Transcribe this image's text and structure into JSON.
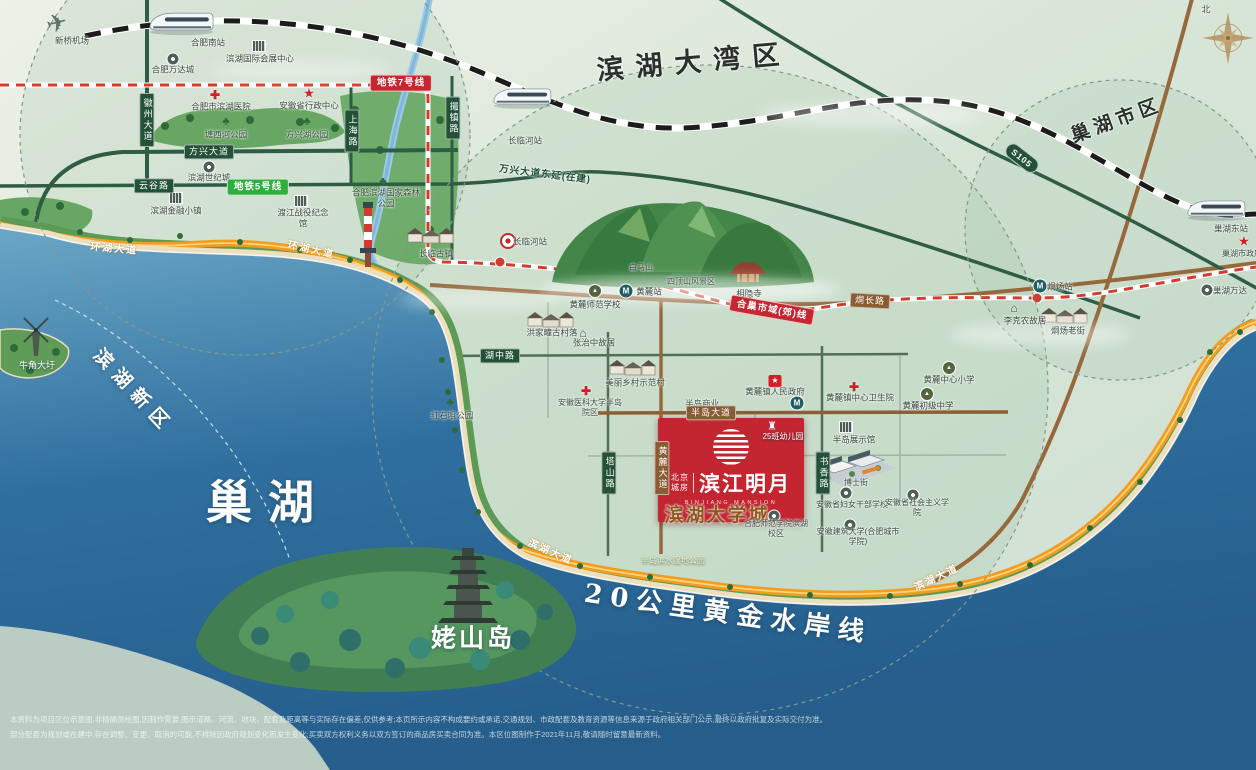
{
  "map": {
    "compass_north": "北",
    "project": {
      "dev1": "北京",
      "dev2": "城房",
      "name": "滨江明月",
      "name_en": "BINJIANG MANSION"
    },
    "disclaimer": [
      "本资料为项目区位示意图,非精确测绘图,因制作需要,图示道路、河流、地块、配套及距离等与实际存在偏差,仅供参考;本页所示内容不构成要约或承诺,交通规划、市政配套及教育资源等信息来源于政府相关部门公示,最终以政府批复及实际交付为准。",
      "部分配套为规划或在建中,存在调整、变更、取消的可能,不排除因政府规划变化而发生变化;买卖双方权利义务以双方签订的商品房买卖合同为准。本区位图制作于2021年11月,敬请随时留意最新资料。"
    ],
    "labels": [
      {
        "n": "label-binhu-bay-area",
        "t": "滨湖大湾区",
        "c": "big-dark",
        "x": 694,
        "y": 63,
        "r": -5,
        "fs": 27,
        "ls": 12
      },
      {
        "n": "label-chaohu-city-area",
        "t": "巢湖市区",
        "c": "big-dark",
        "x": 1117,
        "y": 121,
        "r": -20,
        "fs": 19,
        "ls": 5
      },
      {
        "n": "label-chaohu-lake",
        "t": "巢湖",
        "c": "big-white",
        "x": 268,
        "y": 503,
        "fs": 46,
        "ls": 16
      },
      {
        "n": "label-binhu-new-district",
        "t": "滨湖新区",
        "c": "big-white",
        "x": 133,
        "y": 392,
        "r": 47,
        "fs": 19,
        "ls": 8
      },
      {
        "n": "label-laoshan-island",
        "t": "姥山岛",
        "c": "big-white",
        "x": 473,
        "y": 639,
        "fs": 25,
        "ls": 3
      },
      {
        "n": "label-golden-waterfront",
        "t": "20公里黄金水岸线",
        "c": "big-white serif",
        "x": 728,
        "y": 614,
        "r": 8,
        "fs": 26,
        "ls": 8
      },
      {
        "n": "label-niujiao-daxu",
        "t": "牛角大圩",
        "c": "poi-white",
        "x": 37,
        "y": 366,
        "fs": 9
      },
      {
        "n": "label-binhu-university-town",
        "t": "滨湖大学城",
        "c": "big-brown",
        "x": 717,
        "y": 516,
        "fs": 19,
        "ls": 2
      },
      {
        "n": "label-compass-north",
        "t": "北",
        "x": 1206,
        "y": 10,
        "fs": 9
      },
      {
        "n": "poi-xinqiao-airport",
        "t": "新桥机场",
        "x": 72,
        "y": 41
      },
      {
        "n": "poi-hefei-south-station",
        "t": "合肥南站",
        "x": 208,
        "y": 43
      },
      {
        "n": "poi-binhu-convention-center",
        "t": "滨湖国际会展中心",
        "x": 260,
        "y": 59
      },
      {
        "n": "poi-hefei-wanda-city",
        "t": "合肥万达城",
        "x": 173,
        "y": 70
      },
      {
        "n": "poi-binhu-hospital",
        "t": "合肥市滨湖医院",
        "x": 221,
        "y": 107
      },
      {
        "n": "poi-anhui-admin-center",
        "t": "安徽省行政中心",
        "x": 309,
        "y": 106
      },
      {
        "n": "poi-tangxihe-park",
        "t": "塘西河公园",
        "x": 226,
        "y": 135
      },
      {
        "n": "poi-fangxinghu-park",
        "t": "方兴湖公园",
        "x": 307,
        "y": 135
      },
      {
        "n": "poi-binhu-century-city",
        "t": "滨湖世纪城",
        "x": 209,
        "y": 178
      },
      {
        "n": "poi-binhu-finance-town",
        "t": "滨湖金融小镇",
        "x": 176,
        "y": 211
      },
      {
        "n": "poi-dujiang-memorial",
        "t": "渡江战役纪念馆",
        "x": 303,
        "y": 218,
        "w": 58
      },
      {
        "n": "poi-binhu-forest-park",
        "t": "合肥滨湖国家森林公园",
        "x": 386,
        "y": 198,
        "w": 72
      },
      {
        "n": "poi-hongshiju-park",
        "t": "红石咀公园",
        "x": 452,
        "y": 416
      },
      {
        "n": "poi-changlin-old-town",
        "t": "长临古镇",
        "x": 436,
        "y": 254
      },
      {
        "n": "poi-changlinhe-rail-station",
        "t": "长临河站",
        "x": 525,
        "y": 141
      },
      {
        "n": "poi-changlinhe-metro-station",
        "t": "长临河站",
        "x": 530,
        "y": 242
      },
      {
        "n": "poi-baima-mountain",
        "t": "白马山",
        "x": 641,
        "y": 268,
        "fs": 8
      },
      {
        "n": "poi-dingshan-scenic-area",
        "t": "四顶山风景区",
        "x": 691,
        "y": 282,
        "fs": 8
      },
      {
        "n": "poi-xiangyin-temple",
        "t": "相隐寺",
        "x": 749,
        "y": 294
      },
      {
        "n": "poi-huanglu-station",
        "t": "黄麓站",
        "x": 649,
        "y": 292
      },
      {
        "n": "poi-huanglu-normal-school",
        "t": "黄麓师范学校",
        "x": 595,
        "y": 305
      },
      {
        "n": "poi-hongjiatuan-village",
        "t": "洪家疃古村落",
        "x": 552,
        "y": 333
      },
      {
        "n": "poi-zhangzhizhong-residence",
        "t": "张治中故居",
        "x": 594,
        "y": 343
      },
      {
        "n": "poi-model-village",
        "t": "美丽乡村示范村",
        "x": 635,
        "y": 383
      },
      {
        "n": "poi-medical-univ-hospital",
        "t": "安徽医科大学半岛院区",
        "x": 590,
        "y": 408,
        "w": 66,
        "fs": 8
      },
      {
        "n": "poi-huanglu-government",
        "t": "黄麓镇人民政府",
        "x": 775,
        "y": 392
      },
      {
        "n": "poi-peninsula-commercial",
        "t": "半岛商业",
        "x": 702,
        "y": 404
      },
      {
        "n": "poi-huanglu-health-center",
        "t": "黄麓镇中心卫生院",
        "x": 860,
        "y": 398
      },
      {
        "n": "poi-huanglu-primary-school",
        "t": "黄麓中心小学",
        "x": 949,
        "y": 380
      },
      {
        "n": "poi-huanglu-middle-school",
        "t": "黄麓初级中学",
        "x": 928,
        "y": 406
      },
      {
        "n": "poi-peninsula-exhibition-hall",
        "t": "半岛展示馆",
        "x": 854,
        "y": 440
      },
      {
        "n": "poi-boshi-street",
        "t": "博士街",
        "x": 856,
        "y": 483,
        "fs": 8
      },
      {
        "n": "poi-women-cadre-school",
        "t": "安徽省妇女干部学校",
        "x": 852,
        "y": 505,
        "fs": 8
      },
      {
        "n": "poi-socialism-college",
        "t": "安徽省社会主义学院",
        "x": 917,
        "y": 508,
        "w": 64,
        "fs": 8
      },
      {
        "n": "poi-hefei-normal-univ",
        "t": "合肥师范学院滨湖校区",
        "x": 776,
        "y": 529,
        "w": 66,
        "fs": 8
      },
      {
        "n": "poi-anhui-jianzhu-univ",
        "t": "安徽建筑大学(合肥城市学院)",
        "x": 858,
        "y": 537,
        "w": 84,
        "fs": 8
      },
      {
        "n": "poi-wetland-park",
        "t": "半岛滨水湿地公园",
        "c": "poi-light",
        "x": 673,
        "y": 561,
        "fs": 8
      },
      {
        "n": "poi-kindergarten",
        "t": "25班幼儿园",
        "c": "poi-white",
        "x": 783,
        "y": 437,
        "fs": 8
      },
      {
        "n": "poi-tongyang-station",
        "t": "烔炀站",
        "x": 1060,
        "y": 287
      },
      {
        "n": "poi-likenong-residence",
        "t": "李克农故居",
        "x": 1025,
        "y": 321
      },
      {
        "n": "poi-tongyang-old-street",
        "t": "烔炀老街",
        "x": 1068,
        "y": 331
      },
      {
        "n": "poi-chaohu-wanda",
        "t": "巢湖万达",
        "x": 1230,
        "y": 291
      },
      {
        "n": "poi-chaohu-government",
        "t": "巢湖市政府",
        "x": 1242,
        "y": 254,
        "fs": 8
      },
      {
        "n": "poi-chaohu-east-station",
        "t": "巢湖东站",
        "x": 1231,
        "y": 229
      },
      {
        "n": "road-huizhou-avenue",
        "t": "徽州大道",
        "c": "bar-g v",
        "x": 147,
        "y": 120
      },
      {
        "n": "road-fangxing-avenue",
        "t": "方兴大道",
        "c": "bar-g",
        "x": 209,
        "y": 152
      },
      {
        "n": "road-yungu-road",
        "t": "云谷路",
        "c": "bar-g",
        "x": 154,
        "y": 186
      },
      {
        "n": "road-shanghai-road",
        "t": "上海路",
        "c": "bar-g v",
        "x": 352,
        "y": 131
      },
      {
        "n": "road-cuozhen-road",
        "t": "撮镇路",
        "c": "bar-g v",
        "x": 453,
        "y": 118
      },
      {
        "n": "road-huzhong-road",
        "t": "湖中路",
        "c": "bar-g",
        "x": 500,
        "y": 356
      },
      {
        "n": "road-tashan-road",
        "t": "塔山路",
        "c": "bar-g v",
        "x": 609,
        "y": 473
      },
      {
        "n": "road-huanglu-avenue",
        "t": "黄麓大道",
        "c": "bar-br v",
        "x": 662,
        "y": 468
      },
      {
        "n": "road-shuxiang-road",
        "t": "书香路",
        "c": "bar-g v",
        "x": 823,
        "y": 473
      },
      {
        "n": "road-bandao-avenue",
        "t": "半岛大道",
        "c": "bar-br",
        "x": 711,
        "y": 413
      },
      {
        "n": "road-tongchang-road",
        "t": "烔长路",
        "c": "bar-br",
        "x": 870,
        "y": 301,
        "r": 3
      },
      {
        "n": "road-wanxing-extension",
        "t": "万兴大道东延(在建)",
        "c": "road-text-green",
        "x": 545,
        "y": 175,
        "r": 7
      },
      {
        "n": "road-huanhu-avenue-west",
        "t": "环湖大道",
        "c": "road-orange",
        "x": 114,
        "y": 250,
        "r": 5
      },
      {
        "n": "road-huanhu-avenue-east",
        "t": "环湖大道",
        "c": "road-orange",
        "x": 311,
        "y": 251,
        "r": 12
      },
      {
        "n": "road-binhu-avenue-south",
        "t": "滨湖大道",
        "c": "road-orange",
        "x": 550,
        "y": 553,
        "r": 24
      },
      {
        "n": "road-binhu-avenue-southeast",
        "t": "滨湖大道",
        "c": "road-orange",
        "x": 937,
        "y": 579,
        "r": -25
      },
      {
        "n": "badge-metro-line7",
        "t": "地铁7号线",
        "c": "badge-red",
        "x": 401,
        "y": 83
      },
      {
        "n": "badge-metro-line5",
        "t": "地铁5号线",
        "c": "badge-green",
        "x": 258,
        "y": 187
      },
      {
        "n": "badge-s105",
        "t": "S105",
        "c": "badge-s105",
        "x": 1022,
        "y": 158,
        "r": 38
      },
      {
        "n": "badge-hechao-suburban-line",
        "t": "合巢市域(郊)线",
        "c": "badge-red",
        "x": 772,
        "y": 310,
        "r": 10
      }
    ],
    "icons": [
      {
        "k": "plane",
        "n": "airplane-icon",
        "x": 57,
        "y": 24
      },
      {
        "k": "bldg",
        "n": "convention-center-icon",
        "x": 259,
        "y": 46
      },
      {
        "k": "dot",
        "n": "wanda-city-icon",
        "x": 173,
        "y": 59
      },
      {
        "k": "cross",
        "n": "binhu-hospital-icon",
        "x": 215,
        "y": 95
      },
      {
        "k": "star",
        "n": "admin-center-star-icon",
        "x": 309,
        "y": 93
      },
      {
        "k": "park",
        "n": "tangxihe-park-icon",
        "x": 226,
        "y": 122
      },
      {
        "k": "park",
        "n": "fangxinghu-park-icon",
        "x": 307,
        "y": 122
      },
      {
        "k": "dot",
        "n": "century-city-icon",
        "x": 209,
        "y": 167
      },
      {
        "k": "bldg",
        "n": "finance-town-icon",
        "x": 176,
        "y": 198
      },
      {
        "k": "bldg",
        "n": "dujiang-memorial-icon",
        "x": 301,
        "y": 201
      },
      {
        "k": "park",
        "n": "forest-park-icon",
        "x": 383,
        "y": 182
      },
      {
        "k": "park",
        "n": "hongshiju-park-icon",
        "x": 450,
        "y": 403
      },
      {
        "k": "station",
        "n": "changlinhe-metro-station-icon",
        "x": 508,
        "y": 241
      },
      {
        "k": "m",
        "n": "huanglu-station-m-icon",
        "x": 626,
        "y": 291
      },
      {
        "k": "school",
        "n": "huanglu-normal-school-icon",
        "x": 595,
        "y": 291
      },
      {
        "k": "house",
        "n": "zhangzhizhong-house-icon",
        "x": 583,
        "y": 333
      },
      {
        "k": "cross",
        "n": "medical-univ-cross-icon",
        "x": 586,
        "y": 391
      },
      {
        "k": "gov",
        "n": "huanglu-gov-icon",
        "x": 775,
        "y": 381
      },
      {
        "k": "m",
        "n": "peninsula-station-m-icon",
        "x": 797,
        "y": 403
      },
      {
        "k": "cross",
        "n": "health-center-cross-icon",
        "x": 854,
        "y": 387
      },
      {
        "k": "school",
        "n": "primary-school-icon",
        "x": 949,
        "y": 368
      },
      {
        "k": "school",
        "n": "middle-school-icon",
        "x": 927,
        "y": 394
      },
      {
        "k": "bldg",
        "n": "exhibition-hall-icon",
        "x": 846,
        "y": 427
      },
      {
        "k": "dot",
        "n": "women-school-icon",
        "x": 846,
        "y": 493
      },
      {
        "k": "dot",
        "n": "socialism-college-icon",
        "x": 913,
        "y": 495
      },
      {
        "k": "dot",
        "n": "normal-univ-icon",
        "x": 774,
        "y": 516
      },
      {
        "k": "dot",
        "n": "construction-univ-icon",
        "x": 850,
        "y": 525
      },
      {
        "k": "m",
        "n": "tongyang-station-m-icon",
        "x": 1040,
        "y": 286
      },
      {
        "k": "house",
        "n": "likenong-house-icon",
        "x": 1014,
        "y": 308
      },
      {
        "k": "dot",
        "n": "chaohu-wanda-icon",
        "x": 1207,
        "y": 290
      },
      {
        "k": "star",
        "n": "chaohu-gov-star-icon",
        "x": 1244,
        "y": 241
      },
      {
        "k": "castle",
        "n": "kindergarten-castle-icon",
        "x": 772,
        "y": 427
      }
    ]
  }
}
